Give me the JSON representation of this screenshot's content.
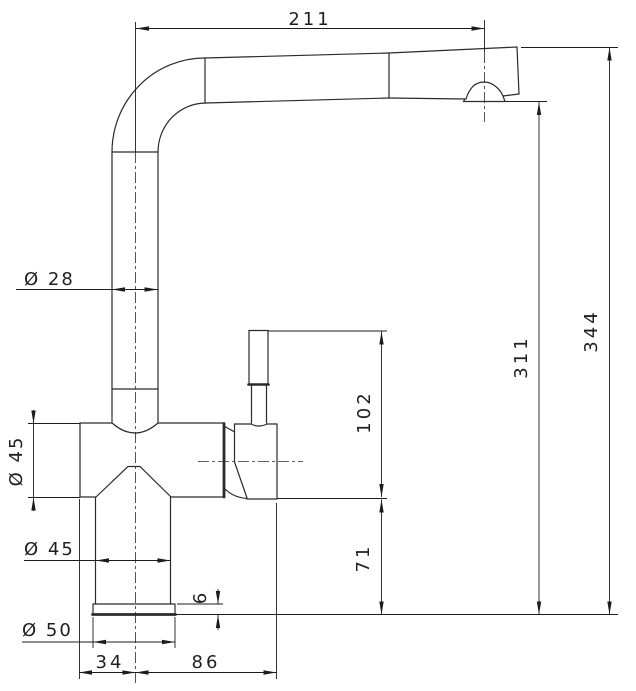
{
  "drawing": {
    "title": "faucet-technical-drawing",
    "colors": {
      "line": "#1f1f1f",
      "background": "#ffffff"
    }
  },
  "dimensions": {
    "spout_reach": "211",
    "overall_height": "344",
    "spout_outlet_height": "311",
    "handle_top_height": "102",
    "body_bottom_height": "71",
    "spout_tube_diameter": "Ø 28",
    "body_diameter": "Ø 45",
    "column_diameter": "Ø 45",
    "base_diameter": "Ø 50",
    "base_plate_thickness": "6",
    "center_to_front_offset": "34",
    "center_to_handle_offset": "86"
  }
}
